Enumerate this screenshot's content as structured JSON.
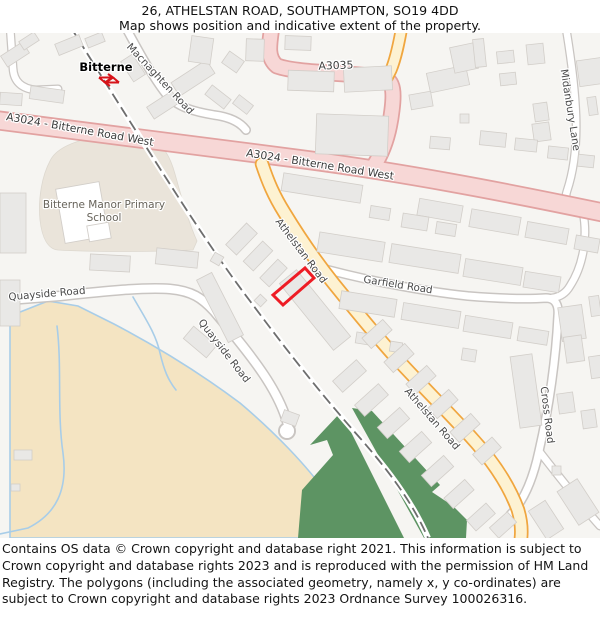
{
  "header": {
    "title": "26, ATHELSTAN ROAD, SOUTHAMPTON, SO19 4DD",
    "subtitle": "Map shows position and indicative extent of the property."
  },
  "map": {
    "station": {
      "name": "Bitterne",
      "icon": "national-rail-double-arrow-icon"
    },
    "labels": {
      "macnaghten": "Macnaghten Road",
      "a3024_w1": "A3024 - Bitterne Road West",
      "a3024_w2": "A3024 - Bitterne Road West",
      "a3035": "A3035",
      "midanbury": "Midanbury Lane",
      "school_line1": "Bitterne Manor Primary",
      "school_line2": "School",
      "quayside1": "Quayside Road",
      "quayside2": "Quayside Road",
      "athelstan1": "Athelstan Road",
      "athelstan2": "Athelstan Road",
      "garfield": "Garfield Road",
      "cross": "Cross Road"
    },
    "colors": {
      "a_road_fill": "#f7d7d6",
      "a_road_casing": "#e2a2a1",
      "minor_yellow_fill": "#fdf2d2",
      "minor_yellow_casing": "#f0a63f",
      "road_fill": "#ffffff",
      "road_casing": "#c9c5c2",
      "building_fill": "#e9e8e6",
      "building_stroke": "#d2cec9",
      "school_ground": "#eae4da",
      "tidal_flat": "#f4e4c2",
      "water_edge": "#a8cde8",
      "greenspace": "#5d9463",
      "railway": "#6e6e6e",
      "plot_outline": "#ee1c25",
      "station_icon": "#d7141a"
    }
  },
  "footer": {
    "copyright": "Contains OS data © Crown copyright and database right 2021. This information is subject to Crown copyright and database rights 2023 and is reproduced with the permission of HM Land Registry. The polygons (including the associated geometry, namely x, y co-ordinates) are subject to Crown copyright and database rights 2023 Ordnance Survey 100026316."
  }
}
